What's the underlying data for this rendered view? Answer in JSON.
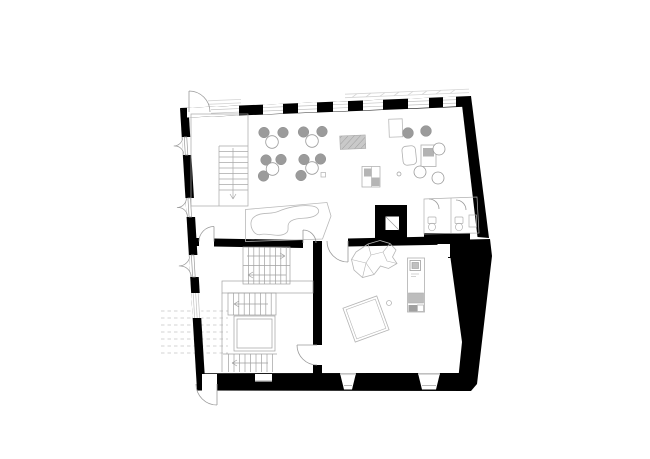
{
  "meta": {
    "description": "black-and-white architectural ground-floor plan drawing on white paper, no text labels"
  },
  "palette": {
    "paper": "#ffffff",
    "wall": "#000000",
    "line": "#9a9a9a",
    "line_light": "#c2c2c2",
    "furniture_fill": "#9b9b9b",
    "furniture_mid": "#b5b5b5",
    "hatch_fill": "#c9c9c9",
    "hatch_line": "#9e9e9e"
  },
  "floorplan": {
    "top_wall": {
      "x1": 180,
      "y1": 108,
      "x2": 471,
      "y2": 96,
      "thickness": 9.8,
      "door_opening": [
        187,
        211
      ],
      "glazed_openings": [
        [
          211,
          239
        ],
        [
          263,
          283
        ],
        [
          298,
          317
        ],
        [
          333,
          348
        ],
        [
          363,
          383
        ],
        [
          408,
          429
        ],
        [
          443,
          456
        ]
      ]
    },
    "left_wall": {
      "x1": 180,
      "y1": 108,
      "x2": 197,
      "y2": 390,
      "thickness": 9,
      "casement_windows": [
        [
          137,
          155
        ],
        [
          198,
          217
        ],
        [
          255,
          277
        ]
      ],
      "lined_window": [
        293,
        318
      ]
    },
    "bottom_wall": {
      "y_inner": 373.2,
      "y_outer": 390,
      "door_gap": [
        202,
        217
      ],
      "sill_window": [
        255,
        272
      ],
      "splayed_windows": [
        [
          340,
          356
        ],
        [
          418,
          440
        ]
      ]
    },
    "dining_clusters": [
      {
        "table": [
          272,
          142
        ],
        "chairs": [
          [
            264,
            132.5
          ],
          [
            283,
            132.5
          ]
        ]
      },
      {
        "table": [
          312,
          141
        ],
        "chairs": [
          [
            303.5,
            132
          ],
          [
            322,
            131.5
          ]
        ]
      },
      {
        "table": [
          272.5,
          169
        ],
        "chairs": [
          [
            266,
            160
          ],
          [
            281,
            159.5
          ],
          [
            263.5,
            176
          ]
        ]
      },
      {
        "table": [
          312,
          168
        ],
        "chairs": [
          [
            304,
            159.5
          ],
          [
            320.5,
            159
          ],
          [
            301,
            175.5
          ]
        ]
      }
    ],
    "lounge_seating": {
      "stools": [
        [
          408,
          133
        ],
        [
          426,
          131
        ]
      ],
      "round_chairs": [
        [
          439,
          149
        ],
        [
          420,
          172
        ],
        [
          438,
          178
        ]
      ],
      "dot": [
        399,
        174
      ]
    }
  }
}
